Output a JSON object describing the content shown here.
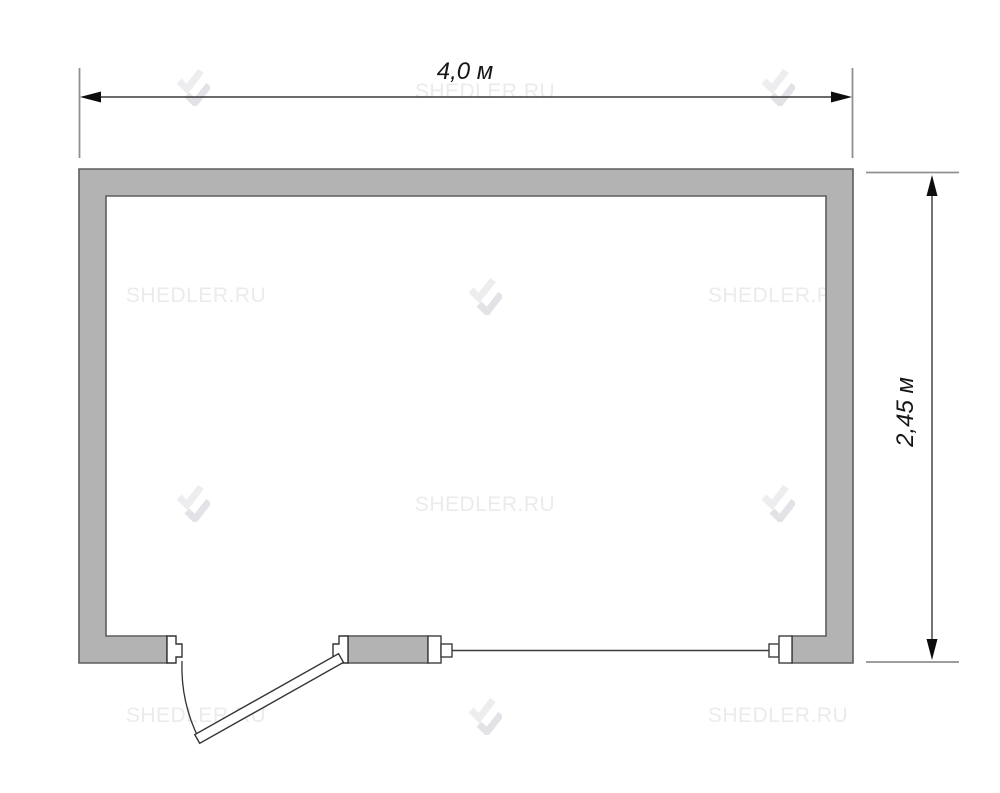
{
  "title": "Floor plan of 4.0 x 2.45 m cabin with door and window",
  "dimensions": {
    "width": "4,0 м",
    "height": "2,45 м"
  },
  "watermark": {
    "text": "SHEDLER.RU",
    "text_color": "#ebebee",
    "logo_color_light": "#ededf0",
    "logo_color_dark": "#e3e3e7"
  },
  "plan": {
    "wall_fill": "#b3b3b3",
    "wall_stroke": "#5e5e5e",
    "drawing_line_color": "#333333",
    "dimension_line_color": "#3a3a3a",
    "extension_line_color": "#909090",
    "features": [
      "door-open-outward",
      "window"
    ]
  }
}
